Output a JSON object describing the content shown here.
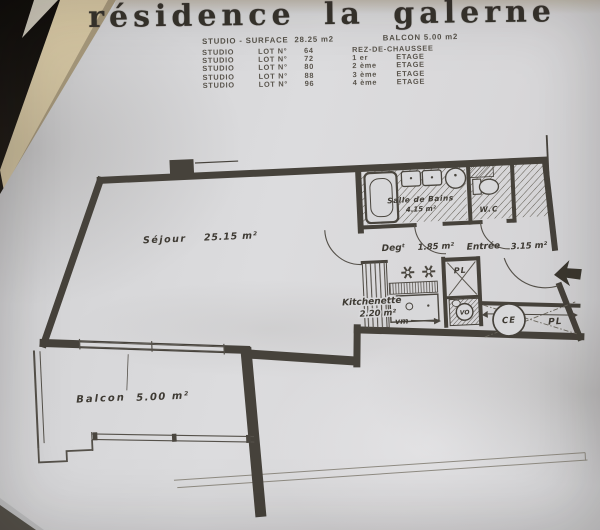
{
  "photo": {
    "background": "#221d17",
    "page_edge_color": "#d2c29e",
    "paper_color": "#d8d8da",
    "ink_color": "#46423b"
  },
  "header": {
    "title": "résidence la galerne",
    "summary_left": "STUDIO - SURFACE  28.25 m2",
    "summary_right": "BALCON 5.00 m2",
    "lot_word": "LOT N°",
    "lots": [
      {
        "type": "STUDIO",
        "num": "64",
        "ord": "REZ-DE-CHAUSSEE",
        "word": ""
      },
      {
        "type": "STUDIO",
        "num": "72",
        "ord": "1 er",
        "word": "ETAGE"
      },
      {
        "type": "STUDIO",
        "num": "80",
        "ord": "2 ème",
        "word": "ETAGE"
      },
      {
        "type": "STUDIO",
        "num": "88",
        "ord": "3 ème",
        "word": "ETAGE"
      },
      {
        "type": "STUDIO",
        "num": "96",
        "ord": "4 ème",
        "word": "ETAGE"
      }
    ]
  },
  "plan": {
    "sejour_name": "Séjour",
    "sejour_area": "25.15 m²",
    "sdb_name": "Salle de Bains",
    "sdb_area": "4.15 m²",
    "wc_label": "W.C",
    "deg_name": "Degᵗ",
    "deg_area": "1.85 m²",
    "entree_name": "Entrée",
    "entree_area": "3.15 m²",
    "kitch_name": "Kitchenette",
    "kitch_area": "2.20 m²",
    "balcon_name": "Balcon",
    "balcon_area": "5.00 m²",
    "vm_label": "vm",
    "pl_top_label": "PL",
    "vo_label": "VO",
    "ce_label": "CE",
    "pl_right_label": "PL"
  }
}
